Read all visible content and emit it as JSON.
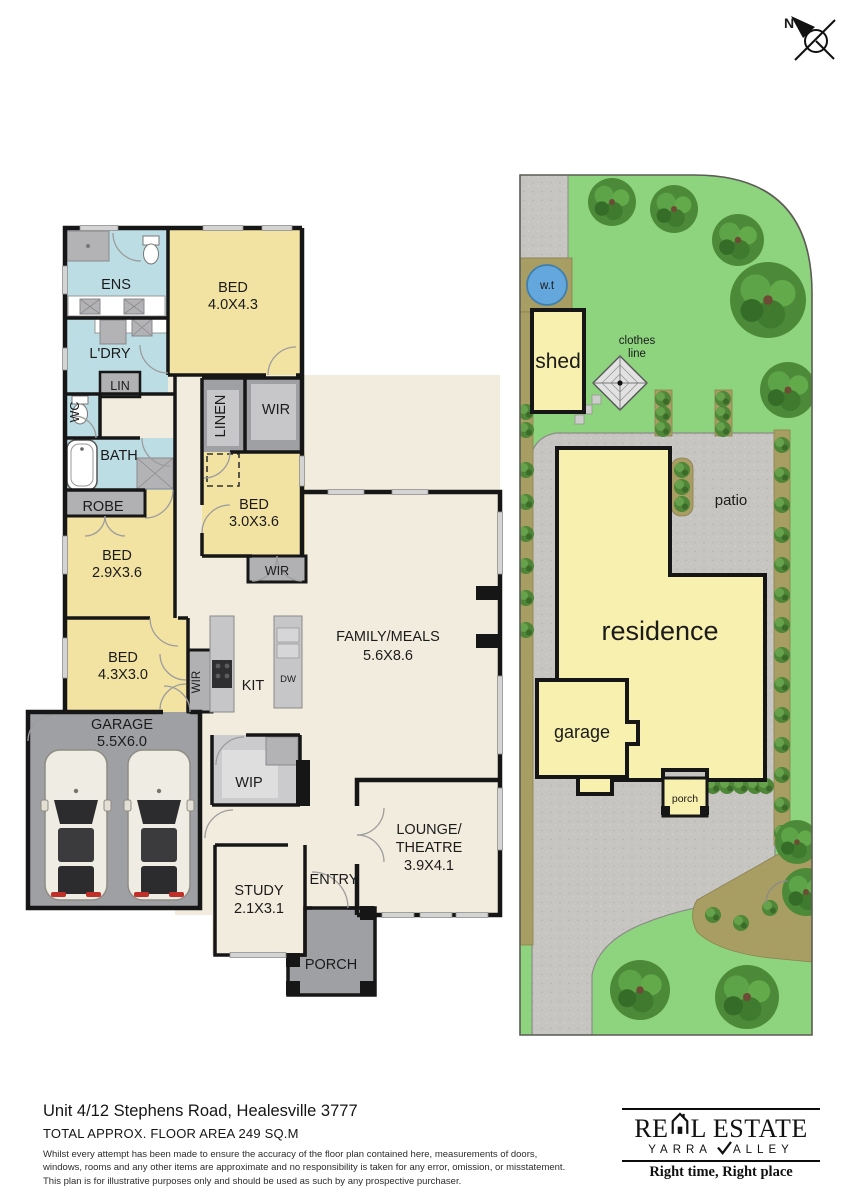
{
  "north_indicator": {
    "label": "N"
  },
  "floor_plan": {
    "ens": {
      "name": "ENS"
    },
    "bed1": {
      "name": "BED",
      "dims": "4.0X4.3"
    },
    "ldry": {
      "name": "L'DRY"
    },
    "lin": {
      "name": "LIN"
    },
    "wc": {
      "name": "WC"
    },
    "bath": {
      "name": "BATH"
    },
    "robe": {
      "name": "ROBE"
    },
    "linen": {
      "name": "LINEN"
    },
    "wir1": {
      "name": "WIR"
    },
    "bed3": {
      "name": "BED",
      "dims": "3.0X3.6"
    },
    "wir2": {
      "name": "WIR"
    },
    "bed2": {
      "name": "BED",
      "dims": "2.9X3.6"
    },
    "bed4": {
      "name": "BED",
      "dims": "4.3X3.0"
    },
    "wir3": {
      "name": "WIR"
    },
    "garage": {
      "name": "GARAGE",
      "dims": "5.5X6.0"
    },
    "kit": {
      "name": "KIT"
    },
    "dw": {
      "name": "DW"
    },
    "wip": {
      "name": "WIP"
    },
    "family": {
      "name": "FAMILY/MEALS",
      "dims": "5.6X8.6"
    },
    "lounge": {
      "name1": "LOUNGE/",
      "name2": "THEATRE",
      "dims": "3.9X4.1"
    },
    "study": {
      "name": "STUDY",
      "dims": "2.1X3.1"
    },
    "entry": {
      "name": "ENTRY"
    },
    "porch": {
      "name": "PORCH"
    }
  },
  "site_plan": {
    "water_tank": "w.t",
    "shed": "shed",
    "clothes_line_line1": "clothes",
    "clothes_line_line2": "line",
    "patio": "patio",
    "residence": "residence",
    "garage": "garage",
    "porch": "porch"
  },
  "footer": {
    "address": "Unit 4/12 Stephens Road, Healesville 3777",
    "floor_area": "TOTAL APPROX. FLOOR AREA 249 SQ.M",
    "disclaimer_line1": "Whilst every attempt has been made to ensure the accuracy of the floor plan contained here, measurements of doors,",
    "disclaimer_line2": "windows, rooms and any other items are approximate and no responsibility is taken for any error, omission, or misstatement.",
    "disclaimer_line3": "This plan is for illustrative purposes only and should be used as such by any prospective purchaser."
  },
  "logo": {
    "brand_part1": "RE",
    "brand_part2": "L ESTATE",
    "region_part1": "YARRA",
    "region_part2": "ALLEY",
    "tagline": "Right time, Right place"
  },
  "colors": {
    "room_yellow": "#f2e3a2",
    "wet_area_blue": "#bcdde4",
    "floor_beige": "#f1ecdd",
    "hard_grey": "#9fa0a3",
    "wall_black": "#161616",
    "lawn_green": "#8ed47f",
    "concrete_grey": "#c6c5c2",
    "garden_bed_olive": "#a89d62",
    "water_tank_blue": "#64a7dc",
    "site_residence_yellow": "#f7f0ae"
  }
}
